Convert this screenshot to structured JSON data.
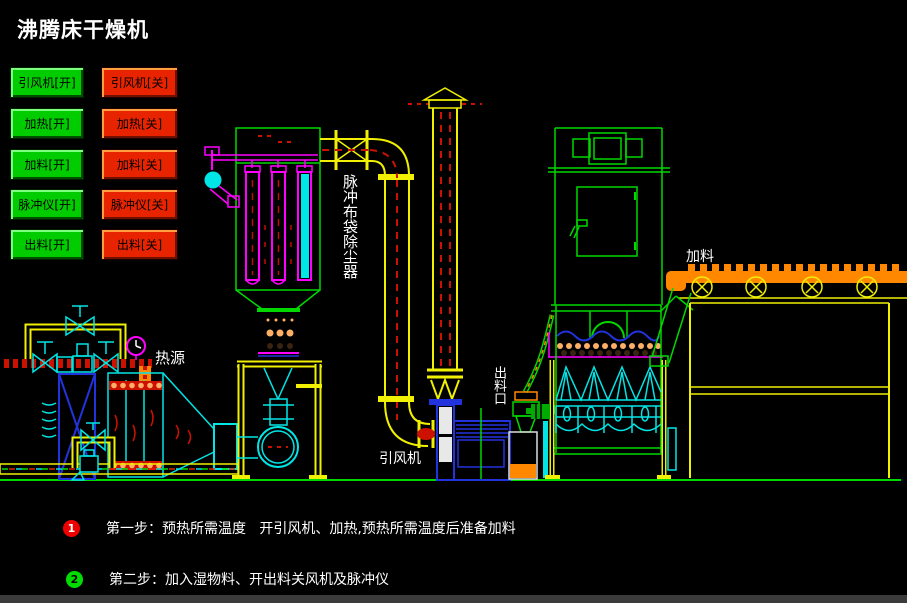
{
  "window": {
    "title": "沸腾床干燥机"
  },
  "palette": {
    "bg": "#000000",
    "txt": "#ffffff",
    "yellow": "#f0f000",
    "green": "#00d800",
    "cyan": "#00e5e5",
    "magenta": "#ff00ff",
    "red": "#cc1100",
    "orange": "#ff8800",
    "blue": "#2233dd",
    "btnGreen": "#00cc00",
    "btnRed": "#e82400",
    "grayBar": "#3b3b3b",
    "step1": "#ee0000",
    "step2": "#00dd00"
  },
  "controls": {
    "open_buttons": [
      "引风机[开]",
      "加热[开]",
      "加料[开]",
      "脉冲仪[开]",
      "出料[开]"
    ],
    "close_buttons": [
      "引风机[关]",
      "加热[关]",
      "加料[关]",
      "脉冲仪[关]",
      "出料[关]"
    ]
  },
  "diagram_labels": {
    "heat_source": "热源",
    "dust_collector": "脉冲布袋除尘器",
    "induced_draft_fan": "引风机",
    "discharge_port": "出料口",
    "feeding": "加料"
  },
  "instructions": [
    {
      "num": "1",
      "text": "第一步：预热所需温度   开引风机、加热,预热所需温度后准备加料"
    },
    {
      "num": "2",
      "text": "第二步：加入湿物料、开出料关风机及脉冲仪"
    }
  ]
}
